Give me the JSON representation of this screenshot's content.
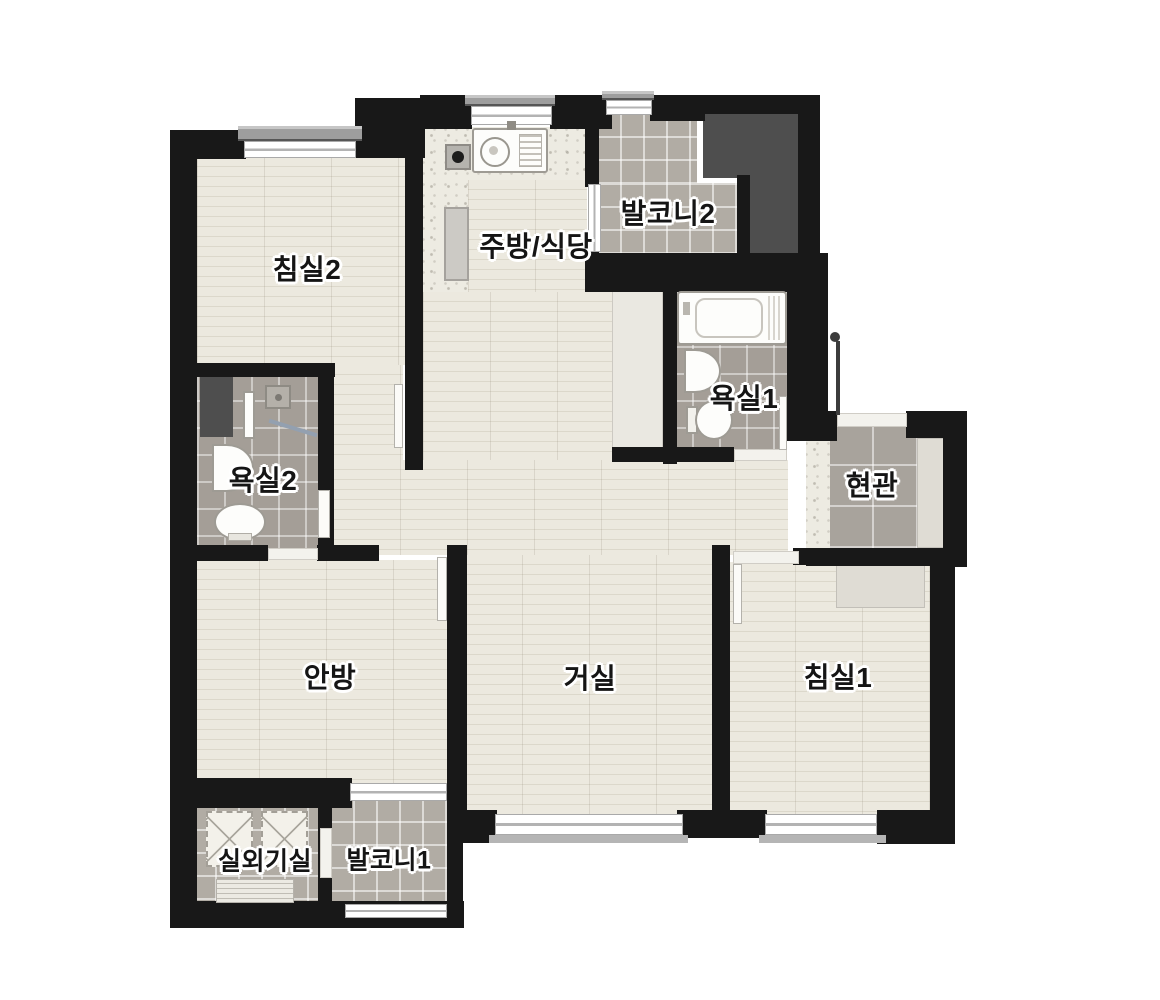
{
  "floorplan": {
    "type": "apartment-floor-plan",
    "language": "ko",
    "rooms": [
      {
        "id": "bedroom2",
        "label": "침실2"
      },
      {
        "id": "kitchen_dining",
        "label": "주방/식당"
      },
      {
        "id": "balcony2",
        "label": "발코니2"
      },
      {
        "id": "bathroom1",
        "label": "욕실1"
      },
      {
        "id": "entrance",
        "label": "현관"
      },
      {
        "id": "bathroom2",
        "label": "욕실2"
      },
      {
        "id": "master_bedroom",
        "label": "안방"
      },
      {
        "id": "living_room",
        "label": "거실"
      },
      {
        "id": "bedroom1",
        "label": "침실1"
      },
      {
        "id": "outdoor_unit_room",
        "label": "실외기실"
      },
      {
        "id": "balcony1",
        "label": "발코니1"
      }
    ],
    "colors": {
      "background": "#ffffff",
      "wall": "#181818",
      "wood_floor": "#e8e4da",
      "balcony_tile": "#b1aca4",
      "bath_tile": "#a49e97",
      "entry_tile": "#a8a39c",
      "kitchen_floor": "#edebe2",
      "core_area": "#4e4e4e",
      "label_text": "#151515"
    },
    "fixtures": [
      "kitchen-sink",
      "cooktop",
      "refrigerator",
      "bathtub",
      "washbasin",
      "toilet",
      "shower-head",
      "towel-bar",
      "front-door",
      "ac-outdoor-unit",
      "vent-louver"
    ]
  }
}
